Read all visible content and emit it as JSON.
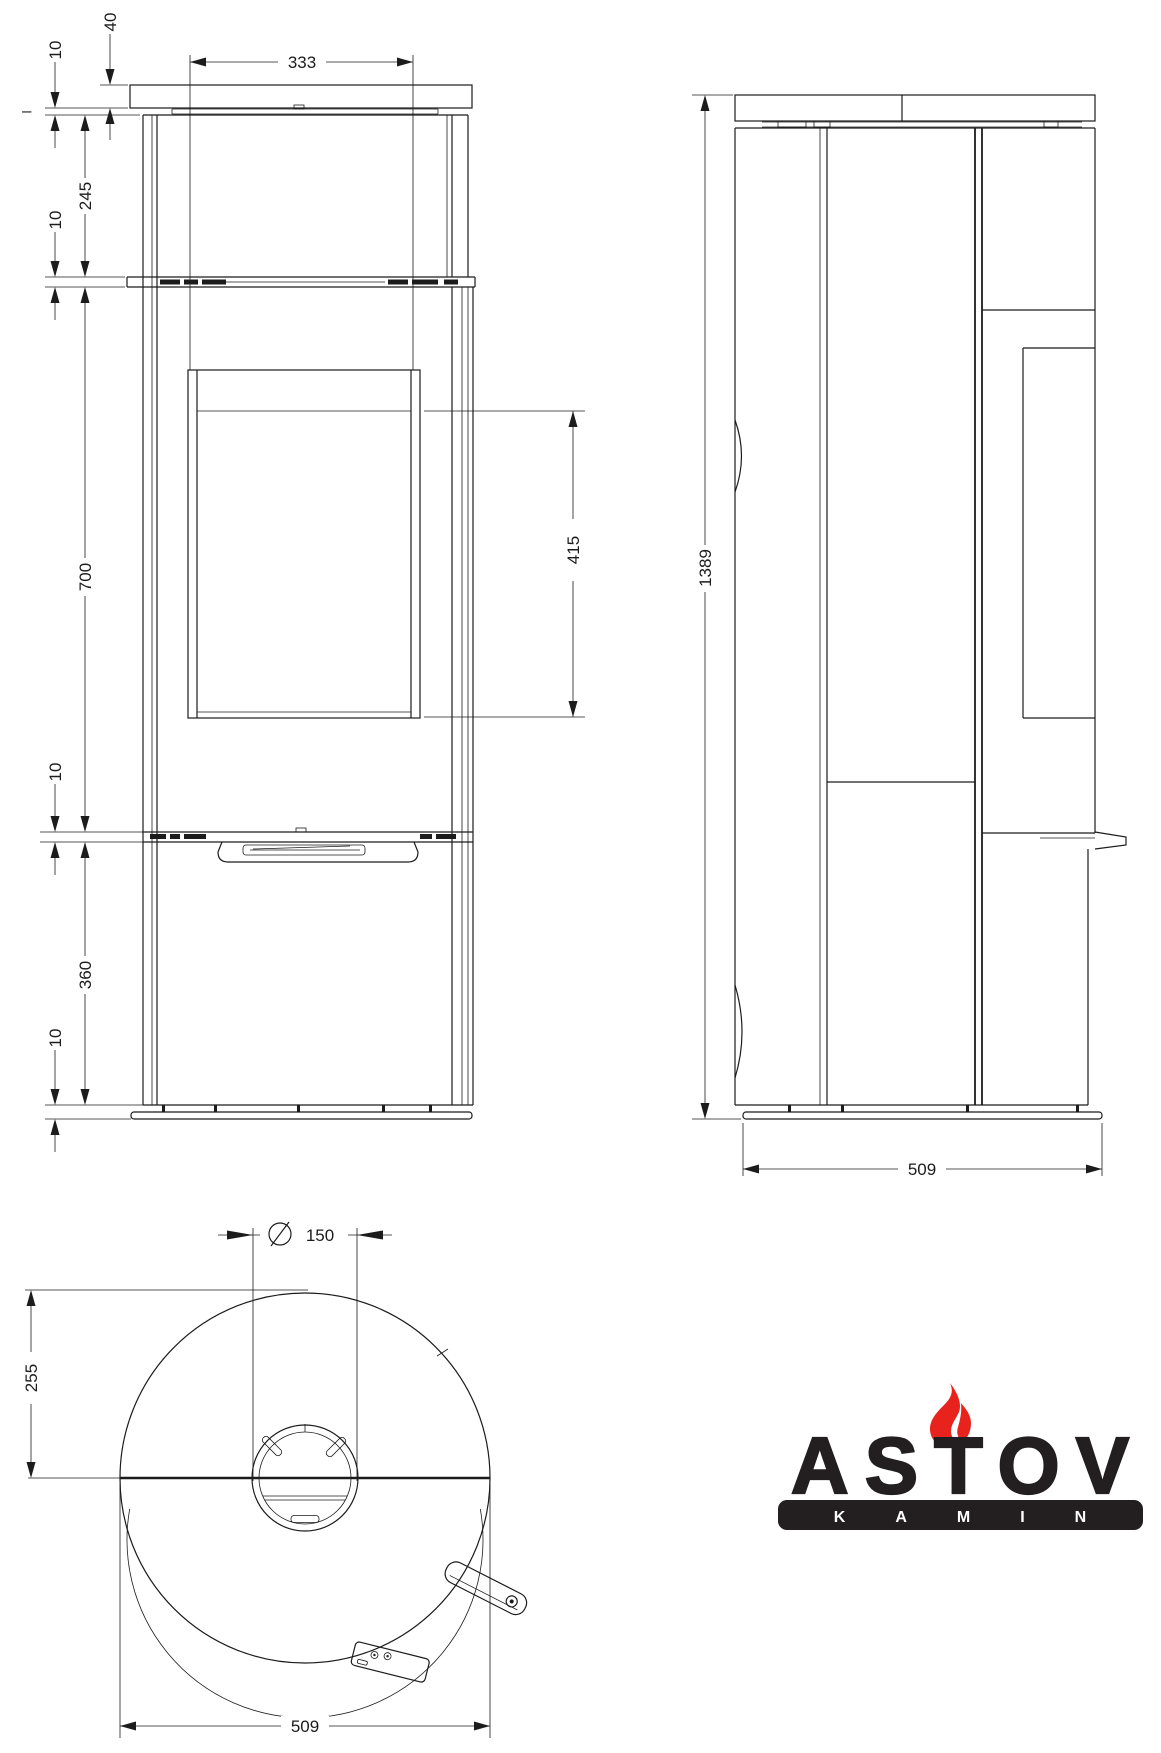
{
  "colors": {
    "line": "#1c1c1c",
    "ink": "#231f20",
    "flame": "#e8231d",
    "background": "#ffffff"
  },
  "front_view": {
    "dims": {
      "plate_thickness": "40",
      "plate_gap": "10",
      "upper_panel": "245",
      "shelf_gap": "10",
      "door_width": "333",
      "glass_height": "415",
      "door_panel": "700",
      "band_gap": "10",
      "lower_panel": "360",
      "base_gap": "10",
      "ref_tick": "–"
    }
  },
  "side_view": {
    "dims": {
      "overall_height": "1389",
      "depth": "509"
    }
  },
  "top_view": {
    "dims": {
      "flue_diameter": "150",
      "rear_offset": "255",
      "width": "509"
    }
  },
  "logo": {
    "brand": "ASTOV",
    "subtitle": "KAMIN"
  }
}
